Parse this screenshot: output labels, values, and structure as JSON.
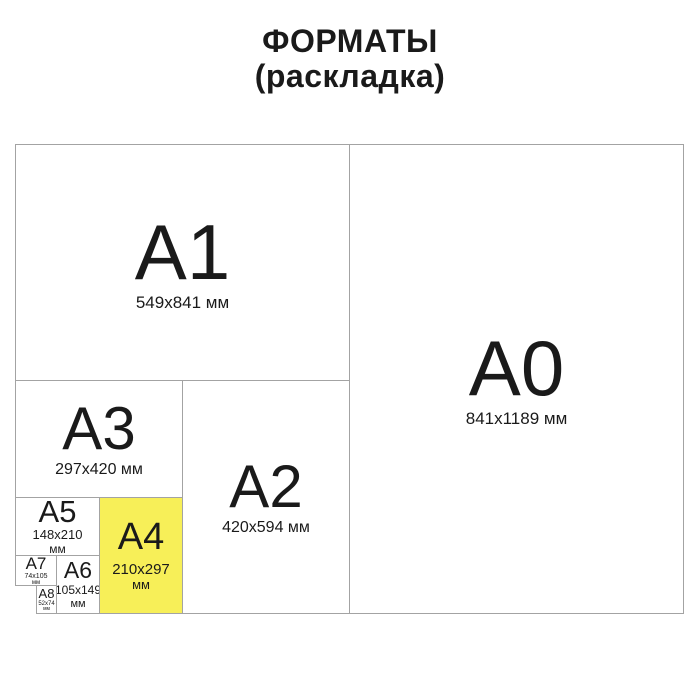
{
  "title": {
    "line1": "ФОРМАТЫ",
    "line2": "(раскладка)"
  },
  "colors": {
    "highlight": "#F7EF58",
    "border": "#A3A3A3",
    "text": "#1A1A1A"
  },
  "formats": {
    "a0": {
      "label": "A0",
      "dimensions": "841x1189 мм"
    },
    "a1": {
      "label": "A1",
      "dimensions": "549x841 мм"
    },
    "a2": {
      "label": "A2",
      "dimensions": "420x594 мм"
    },
    "a3": {
      "label": "A3",
      "dimensions": "297x420 мм"
    },
    "a4": {
      "label": "A4",
      "dimensions": "210x297",
      "unit": "мм",
      "highlighted": true
    },
    "a5": {
      "label": "A5",
      "dimensions": "148x210",
      "unit": "мм"
    },
    "a6": {
      "label": "A6",
      "dimensions": "105x149",
      "unit": "мм"
    },
    "a7": {
      "label": "A7",
      "dimensions": "74x105",
      "unit": "мм"
    },
    "a8": {
      "label": "A8",
      "dimensions": "52x74",
      "unit": "мм"
    }
  }
}
